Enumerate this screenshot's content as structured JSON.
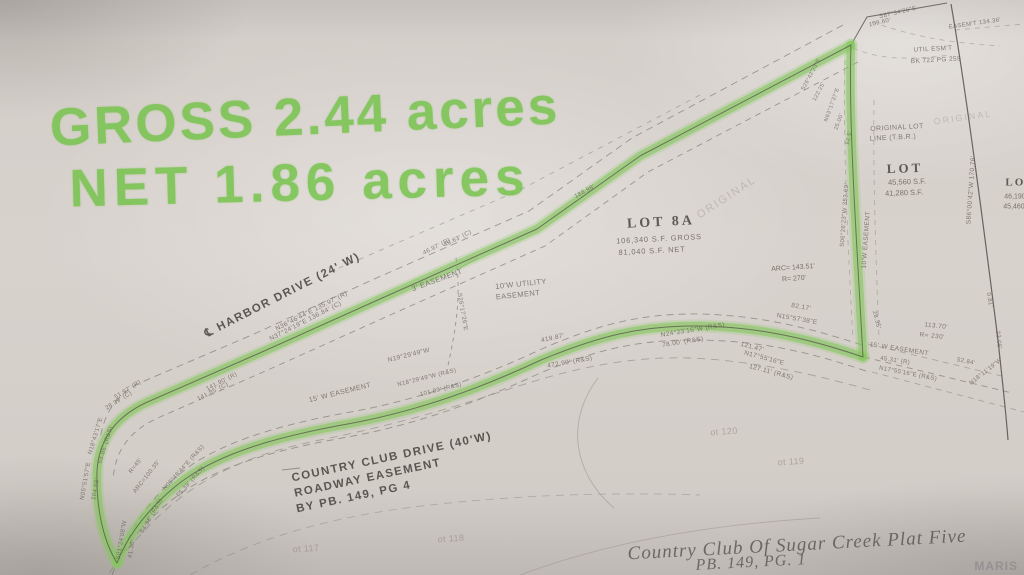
{
  "handwriting": {
    "line1": "GROSS 2.44 acres",
    "line2": "NET 1.86 acres"
  },
  "lot8a": {
    "name": "LOT 8A",
    "gross": "106,340 S.F. GROSS",
    "net": "81,040 S.F. NET",
    "arc": "ARC= 143.51'",
    "radius": "R= 270'"
  },
  "roads": {
    "harbor": "℄ HARBOR DRIVE (24' W)",
    "country_club": "COUNTRY CLUB DRIVE (40'W)",
    "roadway_easement": "ROADWAY EASEMENT",
    "by_pb": "BY PB. 149, PG 4"
  },
  "adjacent_lot": {
    "name": "LOT",
    "sf1": "45,560 S.F.",
    "sf2": "41,280 S.F."
  },
  "edge_lot": {
    "name": "LOT",
    "sf1": "46,190 S.F.",
    "sf2": "45,460 S.F."
  },
  "plat": {
    "title": "Country Club Of Sugar Creek Plat Five",
    "book_page": "PB. 149, PG. 1"
  },
  "watermark": "MARIS",
  "colors": {
    "marker": "#85c75e",
    "pencil": "#6f6962",
    "ink": "#4a453f",
    "paper": "#d5cfca"
  },
  "labels": [
    {
      "t": "N36°46'44\"E 135.97' (R)",
      "x": 312,
      "y": 312,
      "r": -27,
      "s": 6.5,
      "c": "p"
    },
    {
      "t": "N37°24'19\"E 136.84' (C)",
      "x": 306,
      "y": 322,
      "r": -27,
      "s": 6.5,
      "c": "p"
    },
    {
      "t": "46.97' (R)",
      "x": 437,
      "y": 247,
      "r": -27,
      "s": 6,
      "c": "p"
    },
    {
      "t": "46.63' (C)",
      "x": 458,
      "y": 239,
      "r": -27,
      "s": 6,
      "c": "p"
    },
    {
      "t": "188.98'",
      "x": 585,
      "y": 192,
      "r": -29,
      "s": 6,
      "c": "p"
    },
    {
      "t": "3' EASEMENT",
      "x": 437,
      "y": 280,
      "r": -20,
      "s": 7.5,
      "c": "p"
    },
    {
      "t": "10'W UTILITY",
      "x": 521,
      "y": 284,
      "r": -6,
      "s": 7.5,
      "c": "p"
    },
    {
      "t": "EASEMENT",
      "x": 518,
      "y": 295,
      "r": -6,
      "s": 7.5,
      "c": "p"
    },
    {
      "t": "S26°17'26\"E",
      "x": 462,
      "y": 312,
      "r": 80,
      "s": 6,
      "c": "p"
    },
    {
      "t": "419.87'",
      "x": 553,
      "y": 339,
      "r": -12,
      "s": 6.5,
      "c": "p"
    },
    {
      "t": "N19°29'49\"W",
      "x": 409,
      "y": 356,
      "r": -14,
      "s": 6.5,
      "c": "p"
    },
    {
      "t": "472.90' (R&S)",
      "x": 570,
      "y": 363,
      "r": -10,
      "s": 6.5,
      "c": "p"
    },
    {
      "t": "15' W EASEMENT",
      "x": 340,
      "y": 393,
      "r": -14,
      "s": 7,
      "c": "p"
    },
    {
      "t": "N18°29'49\"W (R&S)",
      "x": 427,
      "y": 378,
      "r": -14,
      "s": 6,
      "c": "p"
    },
    {
      "t": "101.89' (R&S)",
      "x": 441,
      "y": 390,
      "r": -14,
      "s": 6,
      "c": "p"
    },
    {
      "t": "141.90' (R)",
      "x": 222,
      "y": 382,
      "r": -27,
      "s": 6,
      "c": "p"
    },
    {
      "t": "141.85' (C)",
      "x": 213,
      "y": 392,
      "r": -27,
      "s": 6,
      "c": "p"
    },
    {
      "t": "51.97' (R)",
      "x": 128,
      "y": 390,
      "r": -32,
      "s": 6,
      "c": "p"
    },
    {
      "t": "28.39' (C)",
      "x": 119,
      "y": 401,
      "r": -32,
      "s": 6,
      "c": "p"
    },
    {
      "t": "N18°43'17\"E",
      "x": 96,
      "y": 436,
      "r": -73,
      "s": 6,
      "c": "p"
    },
    {
      "t": "53.85' (R&S)",
      "x": 106,
      "y": 445,
      "r": -73,
      "s": 6,
      "c": "p"
    },
    {
      "t": "N05°51'57\"E",
      "x": 86,
      "y": 481,
      "r": -80,
      "s": 6,
      "c": "p"
    },
    {
      "t": "104.69'",
      "x": 96,
      "y": 489,
      "r": -80,
      "s": 6,
      "c": "p"
    },
    {
      "t": "R=45'",
      "x": 136,
      "y": 466,
      "r": -52,
      "s": 6,
      "c": "p"
    },
    {
      "t": "ARC=100.35'",
      "x": 147,
      "y": 477,
      "r": -52,
      "s": 6,
      "c": "p"
    },
    {
      "t": "N06°48'44\"E (R&S)",
      "x": 184,
      "y": 468,
      "r": -48,
      "s": 6,
      "c": "p"
    },
    {
      "t": "65.39' (R&S)",
      "x": 191,
      "y": 482,
      "r": -48,
      "s": 6,
      "c": "p"
    },
    {
      "t": "64.38' (R&S)",
      "x": 152,
      "y": 516,
      "r": -60,
      "s": 6,
      "c": "p"
    },
    {
      "t": "S01°24'08\"W",
      "x": 122,
      "y": 540,
      "r": -80,
      "s": 6,
      "c": "p"
    },
    {
      "t": "41.36'",
      "x": 132,
      "y": 549,
      "r": -80,
      "s": 6,
      "c": "p"
    },
    {
      "t": "ORIGINAL",
      "x": 727,
      "y": 198,
      "r": -33,
      "s": 11,
      "c": "v"
    },
    {
      "t": "82.17'",
      "x": 801,
      "y": 308,
      "r": 10,
      "s": 6.5,
      "c": "p"
    },
    {
      "t": "N15°57'38\"E",
      "x": 797,
      "y": 320,
      "r": 10,
      "s": 6.5,
      "c": "p"
    },
    {
      "t": "N24°23'16\"W (R&S)",
      "x": 693,
      "y": 331,
      "r": -9,
      "s": 6.5,
      "c": "p"
    },
    {
      "t": "78.00' (R&S)",
      "x": 683,
      "y": 343,
      "r": -9,
      "s": 6.5,
      "c": "p"
    },
    {
      "t": "121.47'",
      "x": 752,
      "y": 348,
      "r": 15,
      "s": 6.5,
      "c": "p"
    },
    {
      "t": "N17°55'16\"E",
      "x": 764,
      "y": 359,
      "r": 15,
      "s": 6.5,
      "c": "p"
    },
    {
      "t": "127.11' (R&S)",
      "x": 771,
      "y": 373,
      "r": 15,
      "s": 6.5,
      "c": "p"
    },
    {
      "t": "28.35'",
      "x": 876,
      "y": 320,
      "r": 75,
      "s": 6,
      "c": "p"
    },
    {
      "t": "113.70'",
      "x": 936,
      "y": 327,
      "r": 6,
      "s": 6.5,
      "c": "p"
    },
    {
      "t": "R= 230'",
      "x": 932,
      "y": 337,
      "r": 6,
      "s": 6.5,
      "c": "p"
    },
    {
      "t": "15' W EASEMENT",
      "x": 899,
      "y": 350,
      "r": 9,
      "s": 6.5,
      "c": "p"
    },
    {
      "t": "45.31' (R)",
      "x": 895,
      "y": 361,
      "r": 9,
      "s": 6,
      "c": "p"
    },
    {
      "t": "N17°55'16\"E (R&S)",
      "x": 908,
      "y": 374,
      "r": 11,
      "s": 6,
      "c": "p"
    },
    {
      "t": "52.84'",
      "x": 966,
      "y": 362,
      "r": 11,
      "s": 6,
      "c": "p"
    },
    {
      "t": "N18°11'19\"W",
      "x": 986,
      "y": 372,
      "r": -38,
      "s": 6,
      "c": "p"
    },
    {
      "t": "23.06'",
      "x": 998,
      "y": 340,
      "r": 84,
      "s": 6,
      "c": "p"
    },
    {
      "t": "0.81'",
      "x": 989,
      "y": 300,
      "r": 80,
      "s": 6,
      "c": "p"
    },
    {
      "t": "S06°26'23\"W 353.69'",
      "x": 845,
      "y": 215,
      "r": -86,
      "s": 6,
      "c": "p"
    },
    {
      "t": "10'W EASEMENT",
      "x": 867,
      "y": 240,
      "r": -86,
      "s": 6.5,
      "c": "p"
    },
    {
      "t": "S86°00'42\"W 170.76'",
      "x": 972,
      "y": 190,
      "r": -86,
      "s": 6.5,
      "c": "p"
    },
    {
      "t": "ORIGINAL LOT",
      "x": 897,
      "y": 128,
      "r": -3,
      "s": 7,
      "c": "p"
    },
    {
      "t": "LINE (T.B.R.)",
      "x": 893,
      "y": 138,
      "r": -3,
      "s": 7,
      "c": "p"
    },
    {
      "t": "UTIL ESM'T",
      "x": 933,
      "y": 50,
      "r": -3,
      "s": 6.5,
      "c": "p"
    },
    {
      "t": "BK 722 PG 259",
      "x": 936,
      "y": 61,
      "r": -3,
      "s": 6.5,
      "c": "p"
    },
    {
      "t": "ORIGINAL",
      "x": 963,
      "y": 118,
      "r": -8,
      "s": 9,
      "c": "v"
    },
    {
      "t": "S87°34'26\"E",
      "x": 898,
      "y": 13,
      "r": -13,
      "s": 6,
      "c": "p"
    },
    {
      "t": "109.60'",
      "x": 880,
      "y": 23,
      "r": -13,
      "s": 6,
      "c": "p"
    },
    {
      "t": "EASEM'T 134.36'",
      "x": 975,
      "y": 24,
      "r": -8,
      "s": 6,
      "c": "p"
    },
    {
      "t": "S26°42'23\"E",
      "x": 812,
      "y": 75,
      "r": -62,
      "s": 5.5,
      "c": "p"
    },
    {
      "t": "122.25'",
      "x": 820,
      "y": 92,
      "r": -62,
      "s": 5.5,
      "c": "p"
    },
    {
      "t": "N63°17'37\"E",
      "x": 833,
      "y": 105,
      "r": -70,
      "s": 5.5,
      "c": "p"
    },
    {
      "t": "25.00'",
      "x": 840,
      "y": 122,
      "r": -70,
      "s": 5.5,
      "c": "p"
    },
    {
      "t": "52.5'",
      "x": 850,
      "y": 138,
      "r": -78,
      "s": 5.5,
      "c": "p"
    },
    {
      "t": "ot 117",
      "x": 306,
      "y": 549,
      "r": -4,
      "s": 9,
      "c": "f"
    },
    {
      "t": "ot 118",
      "x": 451,
      "y": 539,
      "r": -4,
      "s": 9,
      "c": "f"
    },
    {
      "t": "ot 120",
      "x": 724,
      "y": 432,
      "r": -4,
      "s": 9,
      "c": "f"
    },
    {
      "t": "ot 119",
      "x": 791,
      "y": 462,
      "r": -4,
      "s": 9,
      "c": "f"
    }
  ]
}
